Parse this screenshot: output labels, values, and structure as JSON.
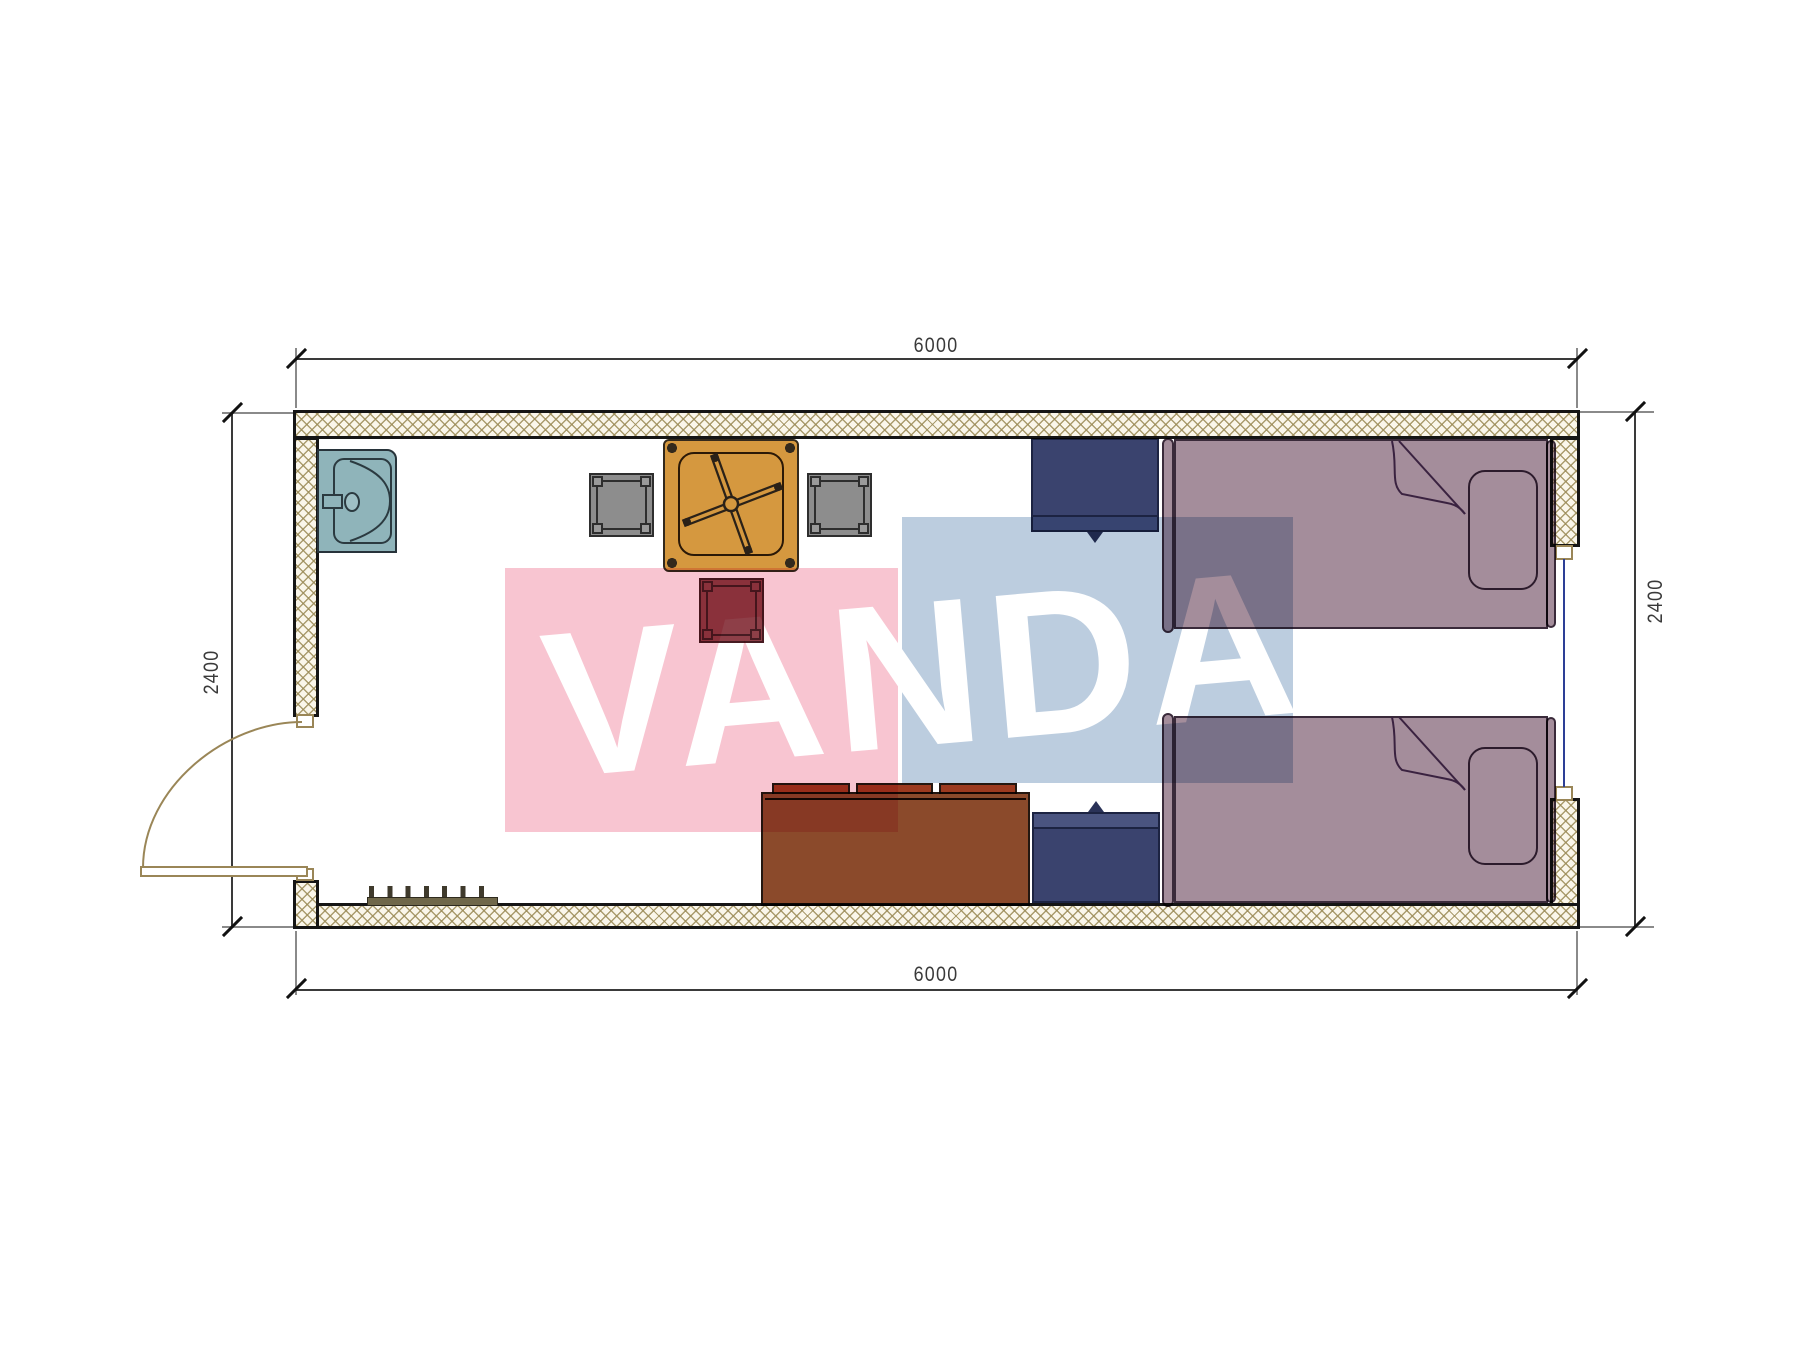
{
  "watermark": {
    "text": "VANDA"
  },
  "dimensions": {
    "top": "6000",
    "bottom": "6000",
    "left": "2400",
    "right": "2400"
  },
  "colors": {
    "wall-fill": "#faf6ea",
    "wall-outline": "#151515",
    "dim-line": "#3a3a3a",
    "dim-text": "#3a3a3a",
    "watermark-pink": "#f8c5d1",
    "watermark-blue": "#bccddf",
    "watermark-text": "#ffffff",
    "sink": "#8fb4ba",
    "table": "#d5983f",
    "stool-gray": "#8d8d8d",
    "stool-maroon": "#8e3f48",
    "sofa": "#8b4a2b",
    "sofa-cushion": "#9c3a1f",
    "cabinet": "#3a436e",
    "cabinet-strip": "#4a5480",
    "bed": "#a48d9b",
    "bed-outline": "#3a2a3a",
    "window-line": "#2d3f96",
    "door-line": "#9a8657",
    "shoe-rack": "#6f6749"
  }
}
